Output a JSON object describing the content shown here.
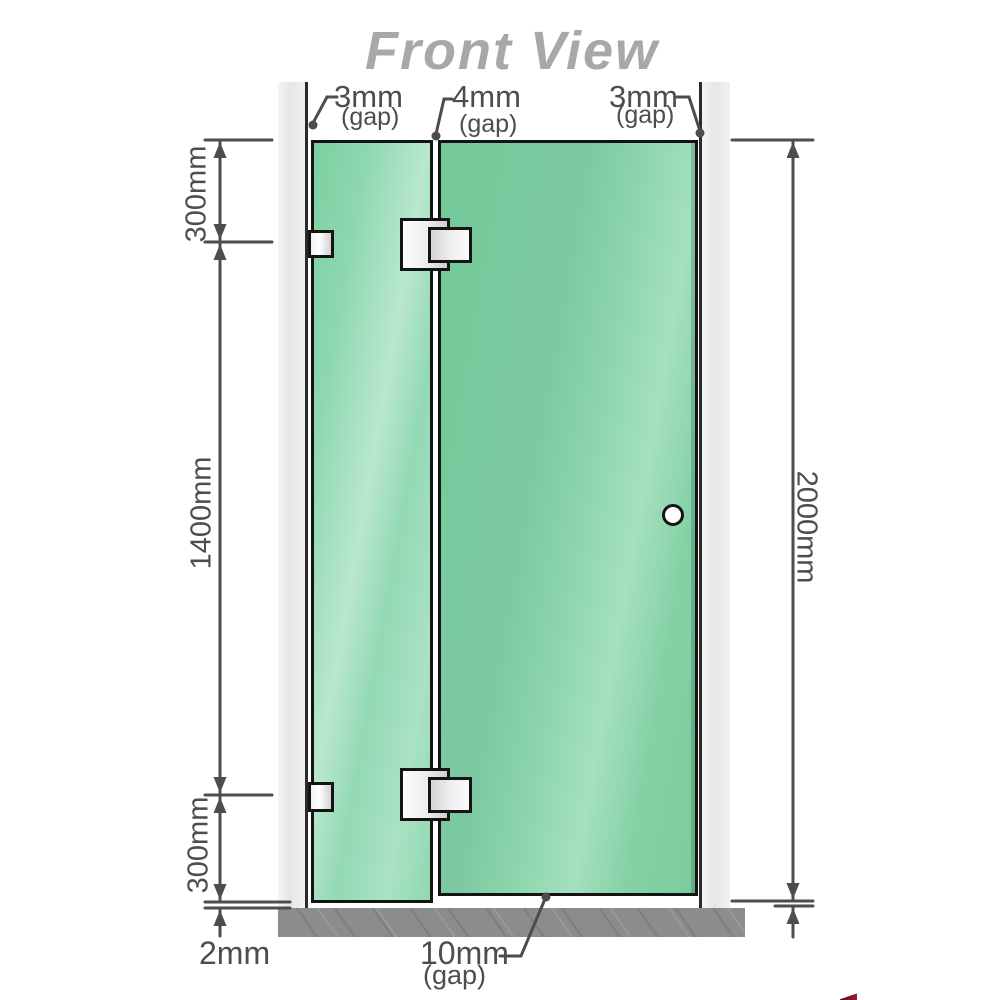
{
  "title": "Front View",
  "annotations": {
    "top_gaps": [
      {
        "value": "3mm",
        "suffix": "(gap)"
      },
      {
        "value": "4mm",
        "suffix": "(gap)"
      },
      {
        "value": "3mm",
        "suffix": "(gap)"
      }
    ],
    "left_dims": {
      "upper": "300mm",
      "middle": "1400mm",
      "lower": "300mm"
    },
    "total_height": "2000mm",
    "floor_thickness": "2mm",
    "door_bottom_gap": {
      "value": "10mm",
      "suffix": "(gap)"
    }
  },
  "colors": {
    "glass_green": "#7cc9a1",
    "glass_highlight": "#b9e7cf",
    "wall_gray": "#ededed",
    "floor_gray": "#8c8c8c",
    "outline_dark": "#141414",
    "dimension_gray": "#4d4d4d",
    "title_gray": "#a8a8a8",
    "watermark_red": "#8a1b2e"
  }
}
